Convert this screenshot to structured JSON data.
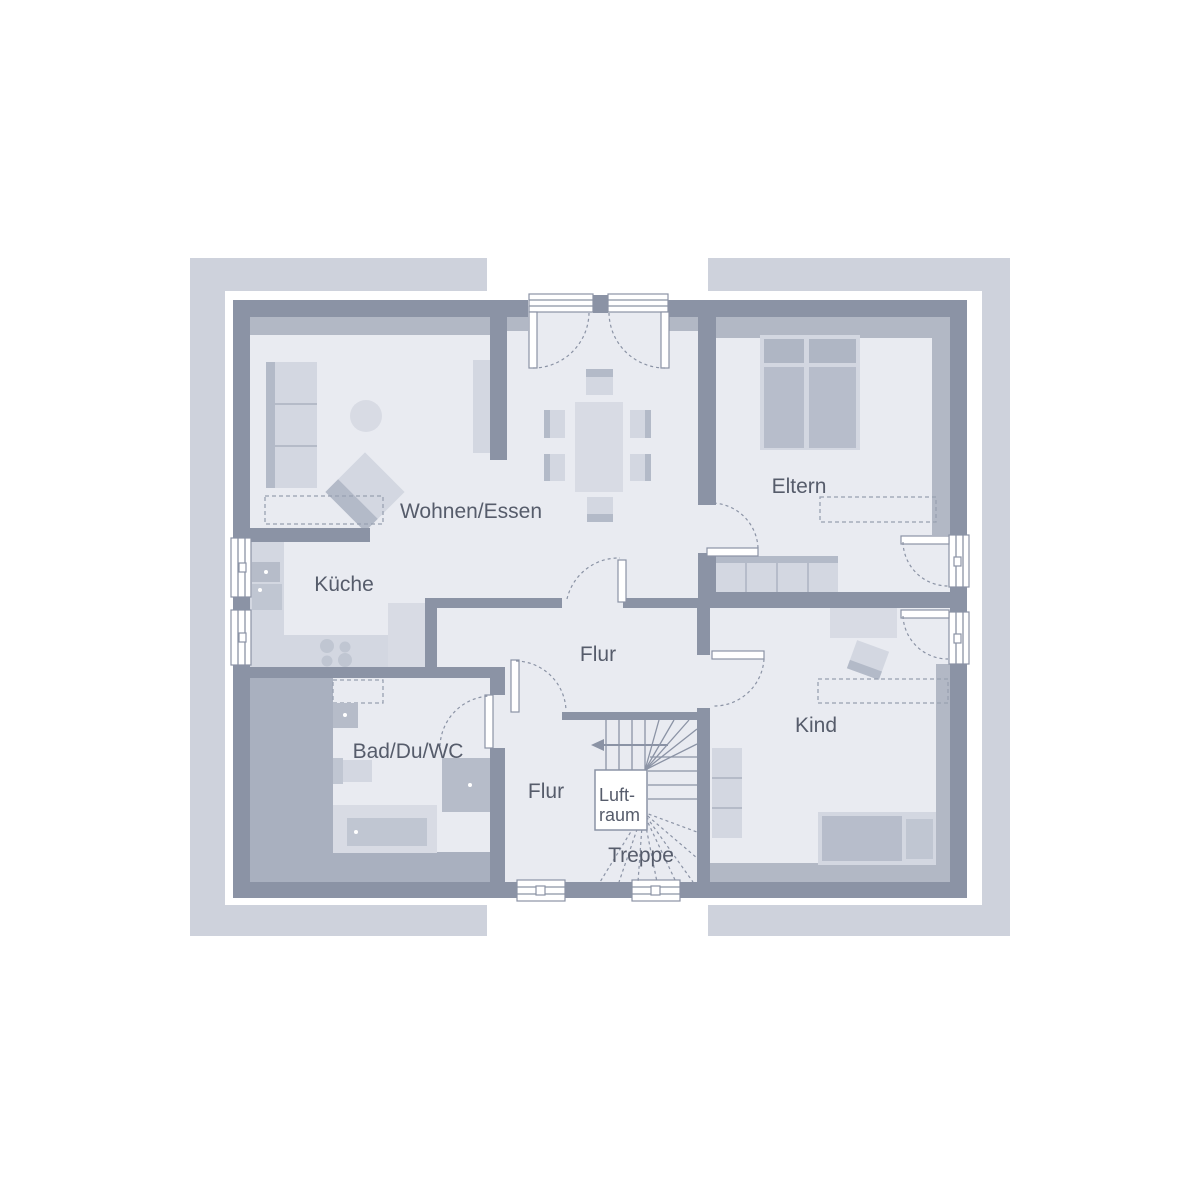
{
  "meta": {
    "type": "architectural-floor-plan"
  },
  "labels": {
    "living_dining": "Wohnen/Essen",
    "kitchen": "Küche",
    "parents": "Eltern",
    "hall_main": "Flur",
    "bath": "Bad/Du/WC",
    "hall_lower": "Flur",
    "child": "Kind",
    "stairs": "Treppe",
    "airspace_line1": "Luft-",
    "airspace_line2": "raum"
  },
  "colors": {
    "background": "#ffffff",
    "outer_frame": "#ced2dc",
    "walls": "#8b93a5",
    "room_floor": "#e9ebf1",
    "knee_wall_band": "#b2b8c5",
    "gray_zone": "#a9b0bf",
    "furniture_light": "#d3d7e1",
    "furniture_medium": "#b7bdcb",
    "text": "#565c6b"
  }
}
